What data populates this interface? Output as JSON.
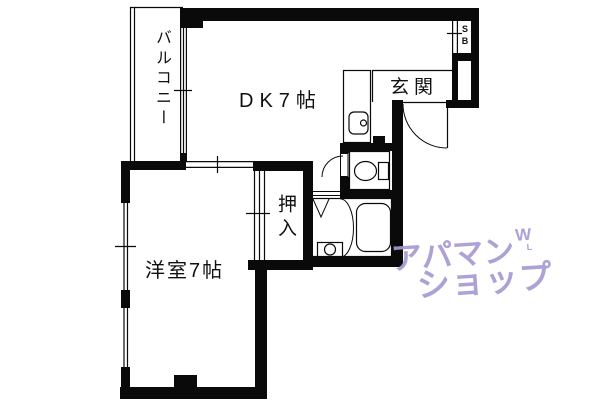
{
  "floor_plan": {
    "rooms": {
      "balcony": {
        "label": "バルコニー"
      },
      "dining_kitchen": {
        "label": "DK7帖"
      },
      "entrance": {
        "label": "玄関"
      },
      "shoe_box": {
        "label": "SB"
      },
      "closet": {
        "label": "押入"
      },
      "western_room": {
        "label": "洋室7帖"
      }
    },
    "fixtures": [
      "kitchen-sink",
      "toilet",
      "bathtub",
      "washbasin"
    ],
    "line_color": "#0a0a0a"
  },
  "watermark": {
    "line1": "アパマン",
    "mark": "W",
    "mark_sub": "L",
    "line2": "ショップ",
    "color": "#a79ad2"
  }
}
